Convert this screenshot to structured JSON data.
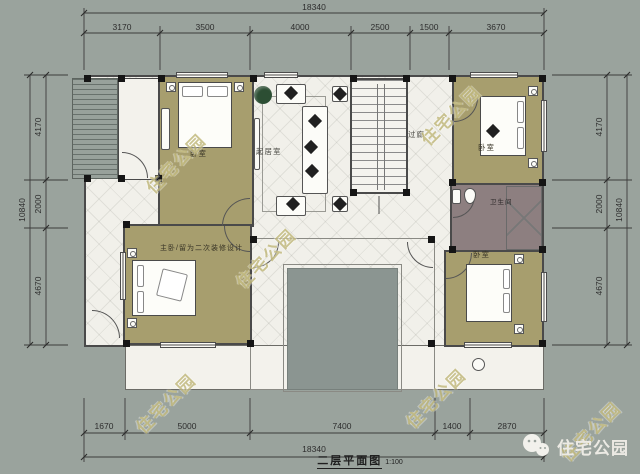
{
  "meta": {
    "caption": "二层平面图",
    "scale": "1:100"
  },
  "brand": {
    "watermark": "住宅公园",
    "logo_text": "住宅公园",
    "logo_icon": "wechat-icon"
  },
  "rooms": {
    "bedroom_top_left": {
      "label": "卧室"
    },
    "living_room": {
      "label": "起居室"
    },
    "corridor": {
      "label": "过廊"
    },
    "bedroom_top_right": {
      "label": "卧室"
    },
    "bathroom": {
      "label": "卫生间"
    },
    "master_bedroom": {
      "label": "主卧/留为二次装修设计"
    },
    "bedroom_bottom_right": {
      "label": "卧室"
    }
  },
  "dimensions": {
    "top": {
      "total": "18340",
      "segments": [
        "3170",
        "3500",
        "4000",
        "2500",
        "1500",
        "3670"
      ]
    },
    "bottom": {
      "total": "18340",
      "segments": [
        "1670",
        "5000",
        "7400",
        "1400",
        "2870"
      ]
    },
    "left": {
      "total": "10840",
      "segments": [
        "4170",
        "2000",
        "4670"
      ]
    },
    "right": {
      "total": "10840",
      "segments": [
        "4170",
        "2000",
        "4670"
      ]
    }
  },
  "colors": {
    "background": "#9aa39d",
    "room_floor": "#a79e6e",
    "bathroom_floor": "#8d7f80",
    "courtyard": "#8b9591",
    "white_floor": "#f1f0ea",
    "wall": "#4a4a4a",
    "watermark": "#bdb373",
    "dimension_text": "#2d2d2d"
  }
}
